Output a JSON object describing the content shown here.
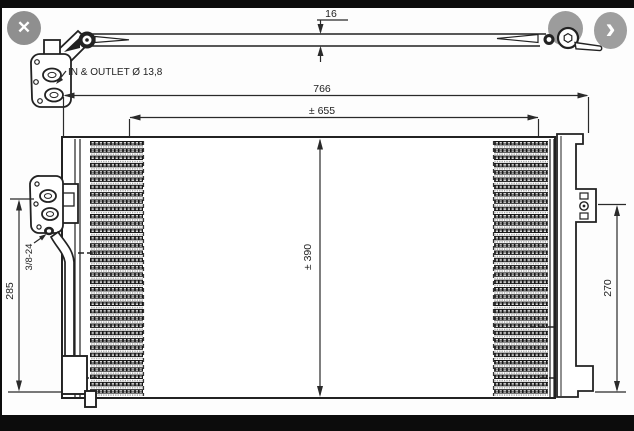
{
  "viewer": {
    "buttons": {
      "close": {
        "icon": "✕"
      },
      "previous": {
        "icon": ""
      },
      "next": {
        "icon": "›"
      }
    },
    "colors": {
      "button_gray": "#9c9c9c",
      "frame_black": "#0c0c0c",
      "line_color": "#222222",
      "background": "#fdfdfd"
    }
  },
  "drawing": {
    "labels": {
      "in_outlet": "IN & OUTLET Ø 13,8",
      "thread": "3/8-24"
    },
    "dimensions": {
      "tube_depth": "16",
      "overall_width": "766",
      "core_width": "± 655",
      "core_height": "± 390",
      "bracket_height": "270",
      "left_height": "285"
    }
  }
}
